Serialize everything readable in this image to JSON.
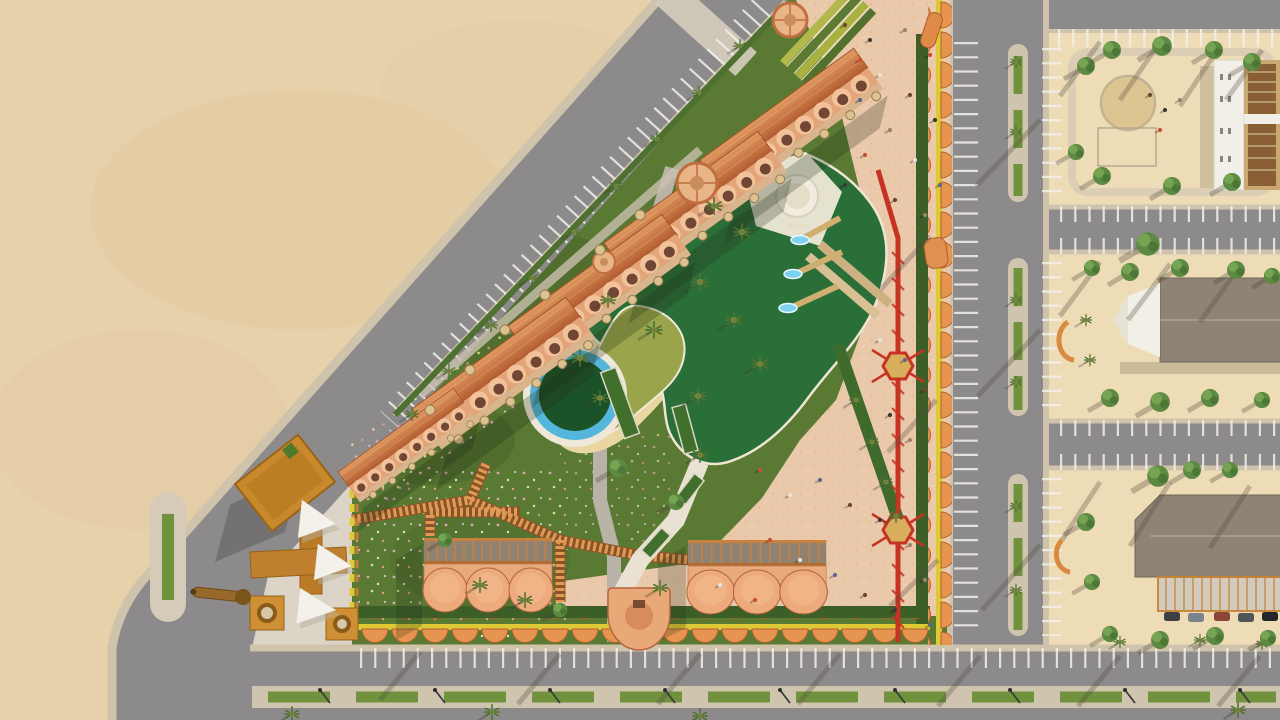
{
  "meta": {
    "title": "Aerial 3D architectural rendering - triangular resort park site plan",
    "view": "top-down bird's-eye render",
    "visible_text": "none"
  },
  "scene": {
    "description": "Top-down render of a triangular resort/park bounded by a diagonal boulevard (desert sand beyond it to the northwest), a vertical street on the east and a boulevard with planted median on the south. Inside: rows of terracotta vaulted chalets, a green swimming lagoon complex with waterslides, pink event plaza with people, red zipline course, scalloped orange canopy perimeter wall, pergola walkways, flower lawns and an orange entrance complex with white shade sails. East of the street: three beige residential blocks with trees, parking, a circular sand playground, a white villa and two gray-roofed buildings, one with a car canopy.",
    "colors": {
      "sand": "#e7d1ab",
      "sand_shade": "#dcc094",
      "block_ground": "#eedcb6",
      "lawn": "#5a7a33",
      "lawn_dark": "#4a662b",
      "corner_plaza": "#dcd5c7",
      "road": "#8d8a8b",
      "sidewalk": "#cfc3ab",
      "median_green": "#70923c",
      "plaza_paving": "#eac9ab",
      "deck_white": "#efe8d8",
      "path_gray": "#b9b2a6",
      "pool_green": "#2a6e38",
      "pool_deep": "#1c5227",
      "lagoon": "#9aa44b",
      "beach_sand": "#e9d6a0",
      "water_blue": "#55b6dc",
      "hedge_green": "#3c5e27",
      "terracotta_roof": "#c4703e",
      "vault_light": "#f2c39b",
      "vault_shadow": "#714634",
      "terrace_tan": "#d9b48c",
      "umbrella_straw": "#dcc28f",
      "canopy_orange": "#e5954f",
      "canopy_yellow": "#ddca35",
      "orange_building": "#c8882c",
      "orange_building_dark": "#9a6418",
      "wood_brown": "#c5813f",
      "red_feature": "#c63322",
      "white_structure": "#f1efe7",
      "roof_gray": "#8e8374",
      "tree_green": "#5d8a42",
      "palm_green": "#4e7231",
      "stripe_white": "#f3f1ea",
      "people_dark": "#6e4434"
    },
    "counts": {
      "chalet_rows": 5,
      "round_dome_pavilions": 3,
      "bottom_scalloped_pavilions": 2,
      "waterslide_flumes": 3,
      "zipline_platforms": 2,
      "residential_blocks": 3,
      "shade_sails": 3,
      "people_approx": 40
    },
    "elements": [
      {
        "name": "desert-sand",
        "desc": "empty sand lot northwest of diagonal boulevard"
      },
      {
        "name": "diagonal-boulevard",
        "desc": "asphalt road with angled parking stripes and palms"
      },
      {
        "name": "south-boulevard",
        "desc": "bottom road with planted median and street lamps"
      },
      {
        "name": "east-street",
        "desc": "vertical road with green median planters and palms"
      },
      {
        "name": "chalet-rows",
        "desc": "terracotta barrel-vault chalet rows with straw umbrellas"
      },
      {
        "name": "event-plaza",
        "desc": "pink paved plaza with scattered people"
      },
      {
        "name": "amphitheater-steps",
        "desc": "green stepped seating at plaza top"
      },
      {
        "name": "main-pool",
        "desc": "free-form dark green pool"
      },
      {
        "name": "kids-lagoon",
        "desc": "olive shallow lagoon with sandy beach"
      },
      {
        "name": "circular-pool",
        "desc": "round pool with blue water ring and green island"
      },
      {
        "name": "spa-pool",
        "desc": "small white round spa at pool deck"
      },
      {
        "name": "waterslides",
        "desc": "three flumes splashing into pool"
      },
      {
        "name": "zipline-course",
        "desc": "red rope course with hexagonal platforms"
      },
      {
        "name": "perimeter-canopy-wall",
        "desc": "orange scalloped canopies with yellow trim"
      },
      {
        "name": "south-gate",
        "desc": "semicircular terracotta gate tower"
      },
      {
        "name": "entrance-complex",
        "desc": "orange buildings, towers and cannon feature at corner"
      },
      {
        "name": "shade-sails",
        "desc": "white tensile canopies"
      },
      {
        "name": "pergola-walkways",
        "desc": "orange wood trellis paths"
      },
      {
        "name": "flower-lawn",
        "desc": "lawn speckled with pink/white flowers"
      },
      {
        "name": "residential-block-north",
        "desc": "plot with circular sand playground and white villa"
      },
      {
        "name": "residential-block-middle",
        "desc": "plot with gray gable-roof building and white entry"
      },
      {
        "name": "residential-block-south",
        "desc": "plot with gray roof building, car canopy and cars"
      },
      {
        "name": "parking-stripes",
        "desc": "white perpendicular parking bays along all roads"
      },
      {
        "name": "palm-trees",
        "desc": "palms along roads, medians and pool"
      },
      {
        "name": "shade-trees",
        "desc": "bushy green trees on residential plots"
      }
    ]
  }
}
